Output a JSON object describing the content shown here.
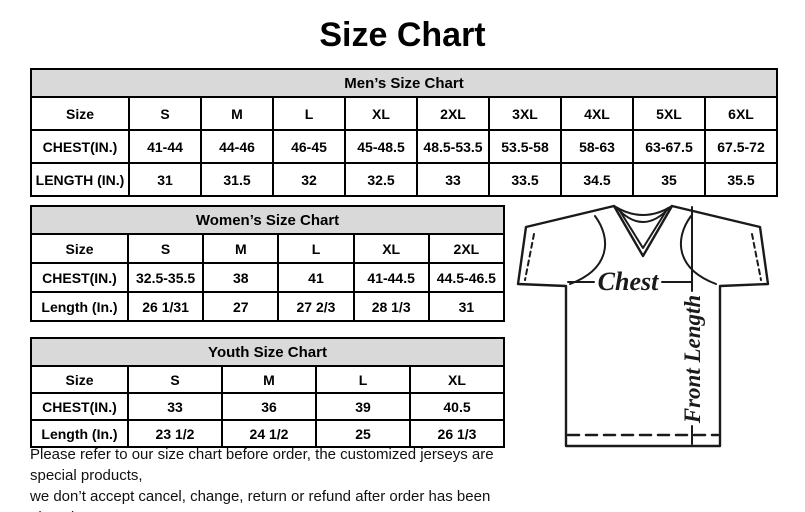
{
  "title": "Size Chart",
  "mens_table": {
    "header": "Men’s Size Chart",
    "rows": [
      [
        "Size",
        "S",
        "M",
        "L",
        "XL",
        "2XL",
        "3XL",
        "4XL",
        "5XL",
        "6XL"
      ],
      [
        "CHEST(IN.)",
        "41-44",
        "44-46",
        "46-45",
        "45-48.5",
        "48.5-53.5",
        "53.5-58",
        "58-63",
        "63-67.5",
        "67.5-72"
      ],
      [
        "LENGTH (IN.)",
        "31",
        "31.5",
        "32",
        "32.5",
        "33",
        "33.5",
        "34.5",
        "35",
        "35.5"
      ]
    ]
  },
  "womens_table": {
    "header": "Women’s Size Chart",
    "rows": [
      [
        "Size",
        "S",
        "M",
        "L",
        "XL",
        "2XL"
      ],
      [
        "CHEST(IN.)",
        "32.5-35.5",
        "38",
        "41",
        "41-44.5",
        "44.5-46.5"
      ],
      [
        "Length (In.)",
        "26 1/31",
        "27",
        "27 2/3",
        "28 1/3",
        "31"
      ]
    ]
  },
  "youth_table": {
    "header": "Youth Size Chart",
    "rows": [
      [
        "Size",
        "S",
        "M",
        "L",
        "XL"
      ],
      [
        "CHEST(IN.)",
        "33",
        "36",
        "39",
        "40.5"
      ],
      [
        "Length (In.)",
        "23 1/2",
        "24 1/2",
        "25",
        "26 1/3"
      ]
    ]
  },
  "diagram": {
    "chest_label": "Chest",
    "front_length_label": "Front Length"
  },
  "footer": {
    "line1": "Please refer to our size chart before order, the customized jerseys are special products,",
    "line2": "we don’t accept cancel, change, return or refund after order has been placed!"
  },
  "colors": {
    "table_header_bg": "#d9d9d9",
    "border": "#000000",
    "text": "#000000"
  }
}
